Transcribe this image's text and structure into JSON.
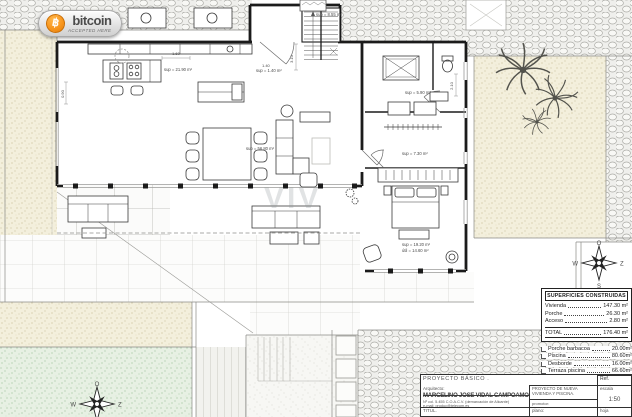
{
  "colors": {
    "bitcoin_orange": "#f7931a",
    "wall_black": "#1b1b1b",
    "sand_beige": "#f3efdc",
    "lawn_green": "#e7f0e3"
  },
  "badge": {
    "coin_symbol": "฿",
    "brand": "bitcoin",
    "tagline": "ACCEPTED HERE"
  },
  "watermark": "VIV",
  "compass": {
    "top": "O",
    "right": "Z",
    "bottom": "S",
    "left": "W"
  },
  "plan_annotations": {
    "kitchen": "sup = 21.90 m²",
    "living": "sup = 56.80 m²",
    "bathroom": "sup = 5.90 m²",
    "dressing": "sup = 7.30 m²",
    "bedroom_built": "sup = 19.20 m²",
    "bedroom_useful": "útil = 14.60 m²",
    "entry": "sup = 8.55 m²",
    "access": "sup = 1.40 m²"
  },
  "dims": {
    "d1": "3.10",
    "d2": "1.60",
    "d3": "2.10",
    "d4": "0.90",
    "d5": "1.40"
  },
  "superficies": {
    "title": "SUPERFICIES CONSTRUIDAS",
    "rows": [
      {
        "label": "Vivienda",
        "value": "147.30 m²"
      },
      {
        "label": "Porche",
        "value": "26.30 m²"
      },
      {
        "label": "Acceso",
        "value": "2.80 m²"
      }
    ],
    "total": {
      "label": "TOTAL",
      "value": "176.40 m²"
    },
    "outdoor": [
      {
        "label": "Porche barbacoa",
        "value": "20.00m²"
      },
      {
        "label": "Piscina",
        "value": "80.60m²"
      },
      {
        "label": "Desborde",
        "value": "16.00m²"
      },
      {
        "label": "Terraza piscina",
        "value": "66.60m²"
      }
    ]
  },
  "titleblock": {
    "project_type": "PROYECTO BÁSICO .",
    "ref_label": "Ref.",
    "architect_label": "Arquitecto:",
    "architect_name": "MARCELINO JOSE VIDAL CAMPOAMOR",
    "architect_line1": "Nº col. 5.455 C.O.A.C.V. (demarcación de Alicante)",
    "architect_line2": "e-mail: produc@telecom.es",
    "titular_label": "TITUL.",
    "project_title": "PROYECTO DE NUEVA VIVIENDA Y PISCINA.",
    "promoter_label": "promotor:",
    "promoter_name": "SAMER MANAGEMENT S.L.",
    "plan_label": "plano:",
    "scale_label": "escala",
    "scale_value": "1:50",
    "sheet_label": "hoja"
  }
}
